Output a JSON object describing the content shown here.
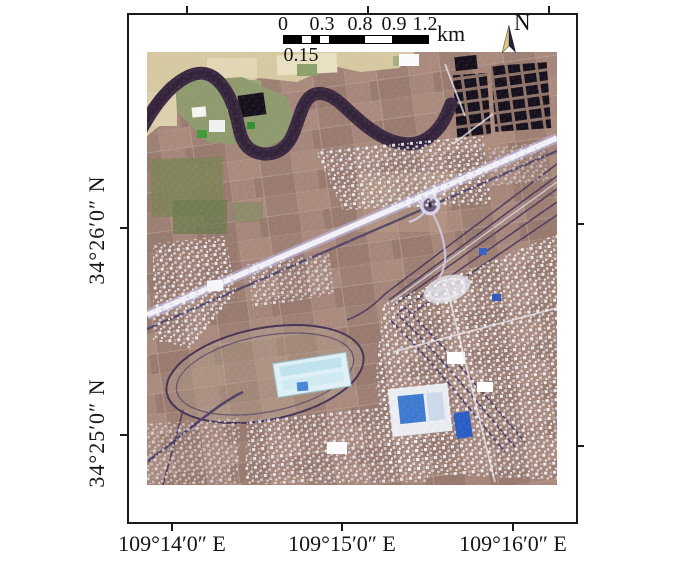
{
  "scalebar": {
    "tick_labels": [
      "0",
      "0.3",
      "0.8",
      "0.9",
      "1.2"
    ],
    "sub_label": "0.15",
    "unit_label": "km"
  },
  "north_arrow": {
    "label": "N"
  },
  "axes": {
    "lat_labels": [
      "34°26′0″ N",
      "34°25′0″ N"
    ],
    "lon_labels": [
      "109°14′0″ E",
      "109°15′0″ E",
      "109°16′0″ E"
    ]
  },
  "colors": {
    "frame": "#1b1b1b",
    "label_text": "#161616",
    "farmland": "#a3837a",
    "upper_fields": "#d6c9a2",
    "river": "#3b2941",
    "river_core": "#2e1f33",
    "highway": "#f2f1f8",
    "highway_glow": "#b9b2d6",
    "road_dark": "#514066",
    "railway": "#4d3a60",
    "urban_white": "#f2f2f5",
    "industrial": "#dff0f6",
    "pond_dark": "#16101c",
    "pool_blue": "#3f7ad0",
    "vegetation": "#7c8257",
    "north_arrow_light": "#d9c87e",
    "north_arrow_dark": "#202038"
  }
}
